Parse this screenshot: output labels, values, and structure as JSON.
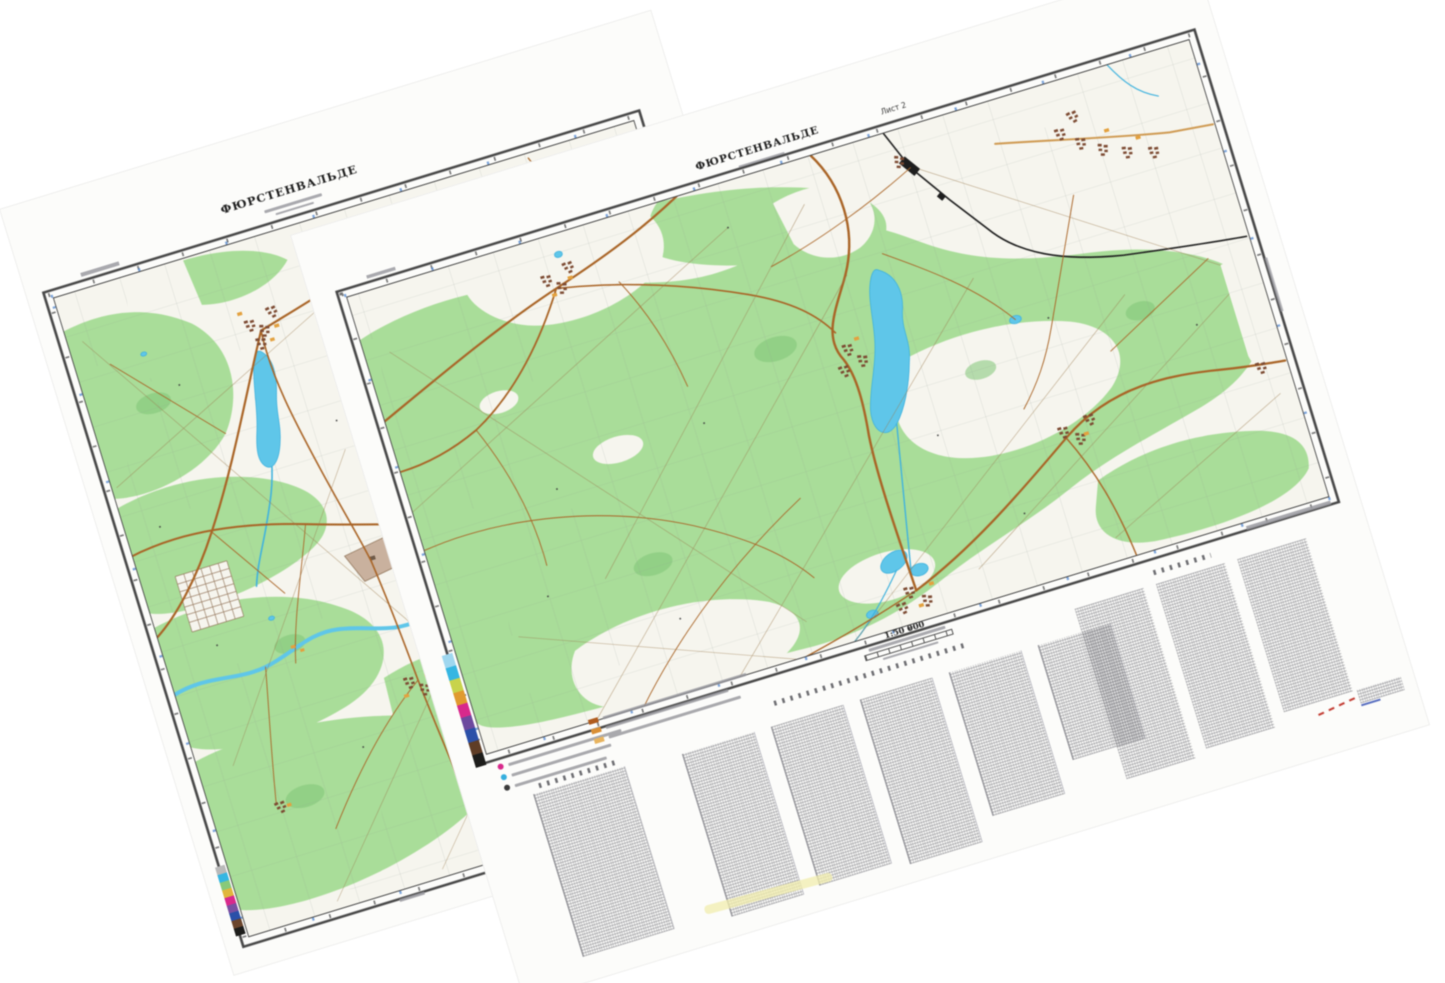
{
  "canvas": {
    "width": 1445,
    "height": 983,
    "background": "#ffffff"
  },
  "left_sheet": {
    "title": "ФЮРСТЕНВАЛЬДЕ",
    "rotation_deg": -17
  },
  "right_sheet": {
    "title": "ФЮРСТЕНВАЛЬДЕ",
    "sheet_label": "Лист 2",
    "scale_label": "1:50 000",
    "rotation_deg": -17
  },
  "colors": {
    "paper": "#fcfcfa",
    "open": "#f6f5ee",
    "forest": "#a9dd99",
    "forest_dark": "#7fc476",
    "water": "#5fc6e9",
    "water_line": "#3fb2de",
    "road": "#a96426",
    "road_light": "#cf9a52",
    "rail": "#1e1e1e",
    "settlement": "#7c4a32",
    "building_orange": "#e3a13f",
    "frame": "#474747",
    "blue_tick": "#4f86cf",
    "annotation_red": "#c23a30",
    "annotation_blue": "#5a6fc0",
    "highlight_yellow": "#f1eeae"
  },
  "legend": {
    "dot_rows": [
      {
        "color": "#d8298c",
        "bar_w": 118
      },
      {
        "color": "#35aede",
        "bar_w": 104
      },
      {
        "color": "#3a3a3a",
        "bar_w": 96
      }
    ],
    "square_rows": [
      {
        "color": "#b05c1e",
        "bar_w": 150
      },
      {
        "color": "#d98f35",
        "bar_w": 128
      },
      {
        "color": "#e8b45f",
        "bar_w": 138
      }
    ],
    "calibration_left": [
      "#b9b9b9",
      "#35b6e2",
      "#88c97a",
      "#e0b63c",
      "#d8298c",
      "#7a4fa2",
      "#2b50a8",
      "#6b452c",
      "#1d1d1b"
    ],
    "calibration_right": [
      "#9fd7ef",
      "#35b6e2",
      "#c8d34b",
      "#e09a2f",
      "#d8298c",
      "#6d4a9e",
      "#2b50a8",
      "#5f3d26",
      "#1d1d1b"
    ]
  },
  "name_list": {
    "columns": [
      {
        "h": 170
      },
      {
        "h": 166
      },
      {
        "h": 172
      },
      {
        "h": 150
      },
      {
        "h": 120
      }
    ]
  },
  "info_blocks": [
    {
      "h": 178
    },
    {
      "h": 172
    },
    {
      "h": 160
    }
  ]
}
